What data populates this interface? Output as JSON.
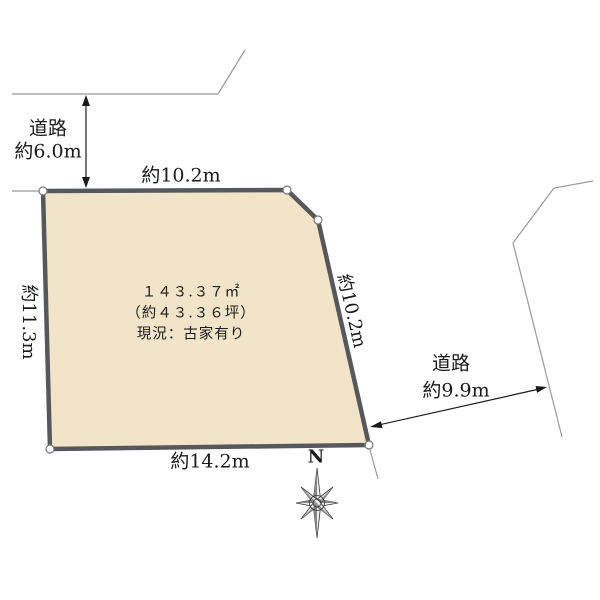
{
  "plot": {
    "area_label": "１４３.３７㎡",
    "tsubo_label": "（約４３.３６坪）",
    "status_label": "現況：古家有り",
    "colors": {
      "fill": "#f2e4c9",
      "border": "#57585c",
      "vertex_fill": "#ffffff"
    }
  },
  "dimensions": {
    "top": "約10.2m",
    "left": "約11.3m",
    "right": "約10.2m",
    "bottom": "約14.2m"
  },
  "roads": {
    "top": {
      "label": "道路",
      "width": "約6.0m"
    },
    "right": {
      "label": "道路",
      "width": "約9.9m"
    }
  },
  "compass": {
    "north": "N"
  },
  "icons": {
    "compass_rose_icon": "eight-point-star"
  },
  "colors": {
    "road_line": "#999999",
    "arrow": "#1a1a1a",
    "text": "#1a1a1a",
    "background": "#ffffff"
  }
}
